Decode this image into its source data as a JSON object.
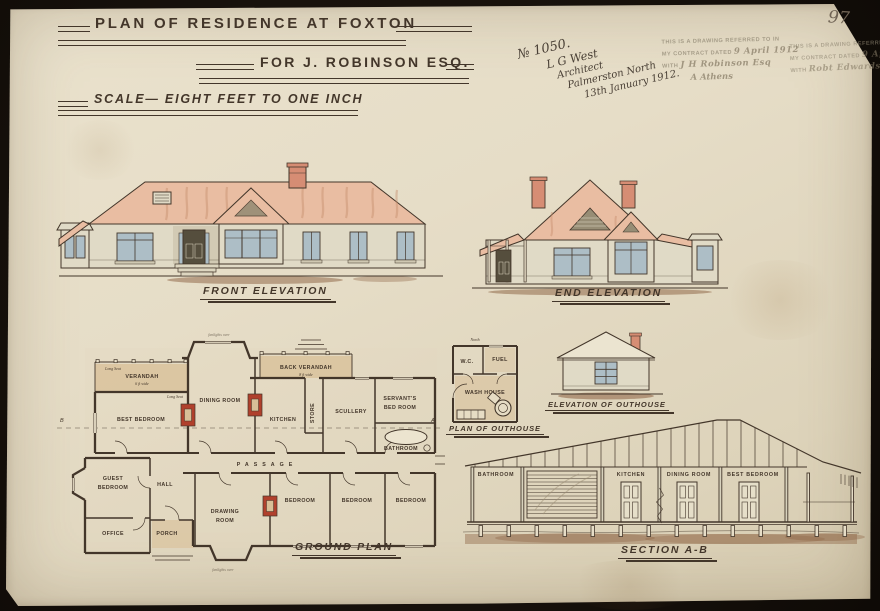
{
  "page": {
    "sheet_number": "97"
  },
  "title": {
    "line1": "PLAN OF RESIDENCE AT FOXTON",
    "line2": "FOR J. ROBINSON ESQ.",
    "scale_line": "SCALE— EIGHT FEET TO ONE INCH"
  },
  "annotation": {
    "job_number": "№ 1050.",
    "name": "L G West",
    "role": "Architect",
    "place": "Palmerston North",
    "date": "13th January 1912."
  },
  "stamps": {
    "printed_line1": "THIS IS A DRAWING REFERRED TO IN",
    "printed_line2": "MY CONTRACT DATED",
    "date_filled": "9 April 1912",
    "printed_with": "WITH",
    "stamp1_signature": "J H Robinson Esq",
    "stamp1_witness": "A Athens",
    "stamp2_signature": "Robt Edwards"
  },
  "labels": {
    "front_elevation": "FRONT ELEVATION",
    "end_elevation": "END ELEVATION",
    "ground_plan": "GROUND PLAN",
    "plan_of_outhouse": "PLAN OF OUTHOUSE",
    "elevation_of_outhouse": "ELEVATION OF OUTHOUSE",
    "section": "SECTION A-B"
  },
  "ground_plan": {
    "rooms": {
      "verandah": "VERANDAH",
      "verandah_width": "6 ft wide",
      "long_seat": "Long Seat",
      "best_bedroom": "BEST BEDROOM",
      "dining_room": "DINING ROOM",
      "back_verandah": "BACK VERANDAH",
      "back_verandah_width": "8 ft wide",
      "store": "STORE",
      "kitchen": "KITCHEN",
      "scullery": "SCULLERY",
      "servants_line1": "SERVANT'S",
      "servants_line2": "BED ROOM",
      "bathroom": "BATHROOM",
      "passage": "PASSAGE",
      "guest_line1": "GUEST",
      "guest_line2": "BEDROOM",
      "hall": "HALL",
      "office": "OFFICE",
      "porch": "PORCH",
      "drawing_line1": "DRAWING",
      "drawing_line2": "ROOM",
      "bedroom": "BEDROOM"
    },
    "markers": {
      "a": "A",
      "b": "B"
    },
    "notes": {
      "fanlights": "fanlights over"
    }
  },
  "outhouse": {
    "north": "North",
    "wc": "W.C.",
    "fuel": "FUEL",
    "wash_house": "WASH HOUSE"
  },
  "section_rooms": {
    "bathroom": "BATHROOM",
    "kitchen": "KITCHEN",
    "dining_room": "DINING ROOM",
    "best_bedroom": "BEST BEDROOM"
  },
  "colors": {
    "paper": "#e6ddc7",
    "ink": "#43362a",
    "roof_wash": "#e9bda2",
    "wall_wash": "#e0dac6",
    "chimney": "#d68d74",
    "window_pane": "#adbec6",
    "ground_wash": "#8a5f3f",
    "fireplace": "#b0402c",
    "plan_floor": "#d8bf97",
    "door_dark": "#554e3d",
    "streak": "#c48a6a",
    "stamp_ink": "#8e8571",
    "pencil": "#6f6354",
    "vent": "#978d75"
  }
}
